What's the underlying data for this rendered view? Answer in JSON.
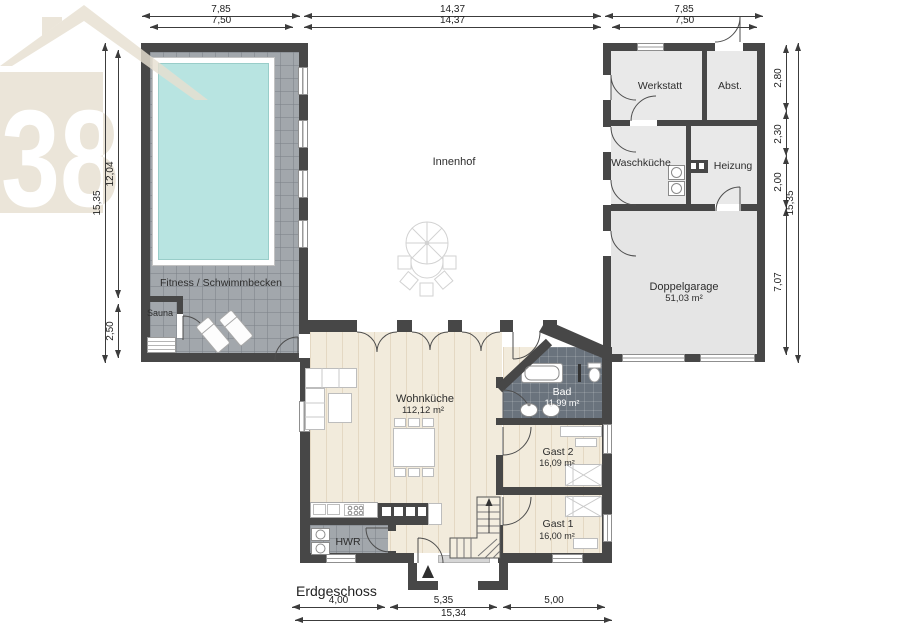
{
  "logo": {
    "number": "38"
  },
  "floor_label": "Erdgeschoss",
  "courtyard": {
    "label": "Innenhof"
  },
  "rooms": {
    "fitness": {
      "name": "Fitness / Schwimmbecken"
    },
    "sauna": {
      "name": "Sauna"
    },
    "werkstatt": {
      "name": "Werkstatt"
    },
    "abstellraum": {
      "name": "Abst."
    },
    "waschkueche": {
      "name": "Waschküche"
    },
    "heizung": {
      "name": "Heizung"
    },
    "doppelgarage": {
      "name": "Doppelgarage",
      "area": "51,03 m²"
    },
    "wohnkueche": {
      "name": "Wohnküche",
      "area": "112,12 m²"
    },
    "bad": {
      "name": "Bad",
      "area": "11,99 m²"
    },
    "gast2": {
      "name": "Gast 2",
      "area": "16,09 m²"
    },
    "gast1": {
      "name": "Gast 1",
      "area": "16,00 m²"
    },
    "hwr": {
      "name": "HWR"
    }
  },
  "dimensions": {
    "top_outer_left": "7,85",
    "top_outer_mid": "14,37",
    "top_outer_right": "7,85",
    "top_inner_left": "7,50",
    "top_inner_mid": "14,37",
    "top_inner_right": "7,50",
    "left_outer": "15,35",
    "left_upper": "12,04",
    "left_lower": "2,50",
    "right_seg1": "2,80",
    "right_seg2": "2,30",
    "right_seg3": "2,00",
    "right_seg4": "7,07",
    "right_outer": "15,35",
    "bottom_left": "4,00",
    "bottom_mid": "5,35",
    "bottom_right": "5,00",
    "bottom_total": "15,34"
  },
  "colors": {
    "wall": "#474747",
    "pool_water": "#b8e4e1",
    "wood_floor": "#f2ebdc",
    "tile_floor": "#a2a7ac",
    "bad_tile": "#6a737d",
    "logo_beige": "#e7e0d1"
  }
}
